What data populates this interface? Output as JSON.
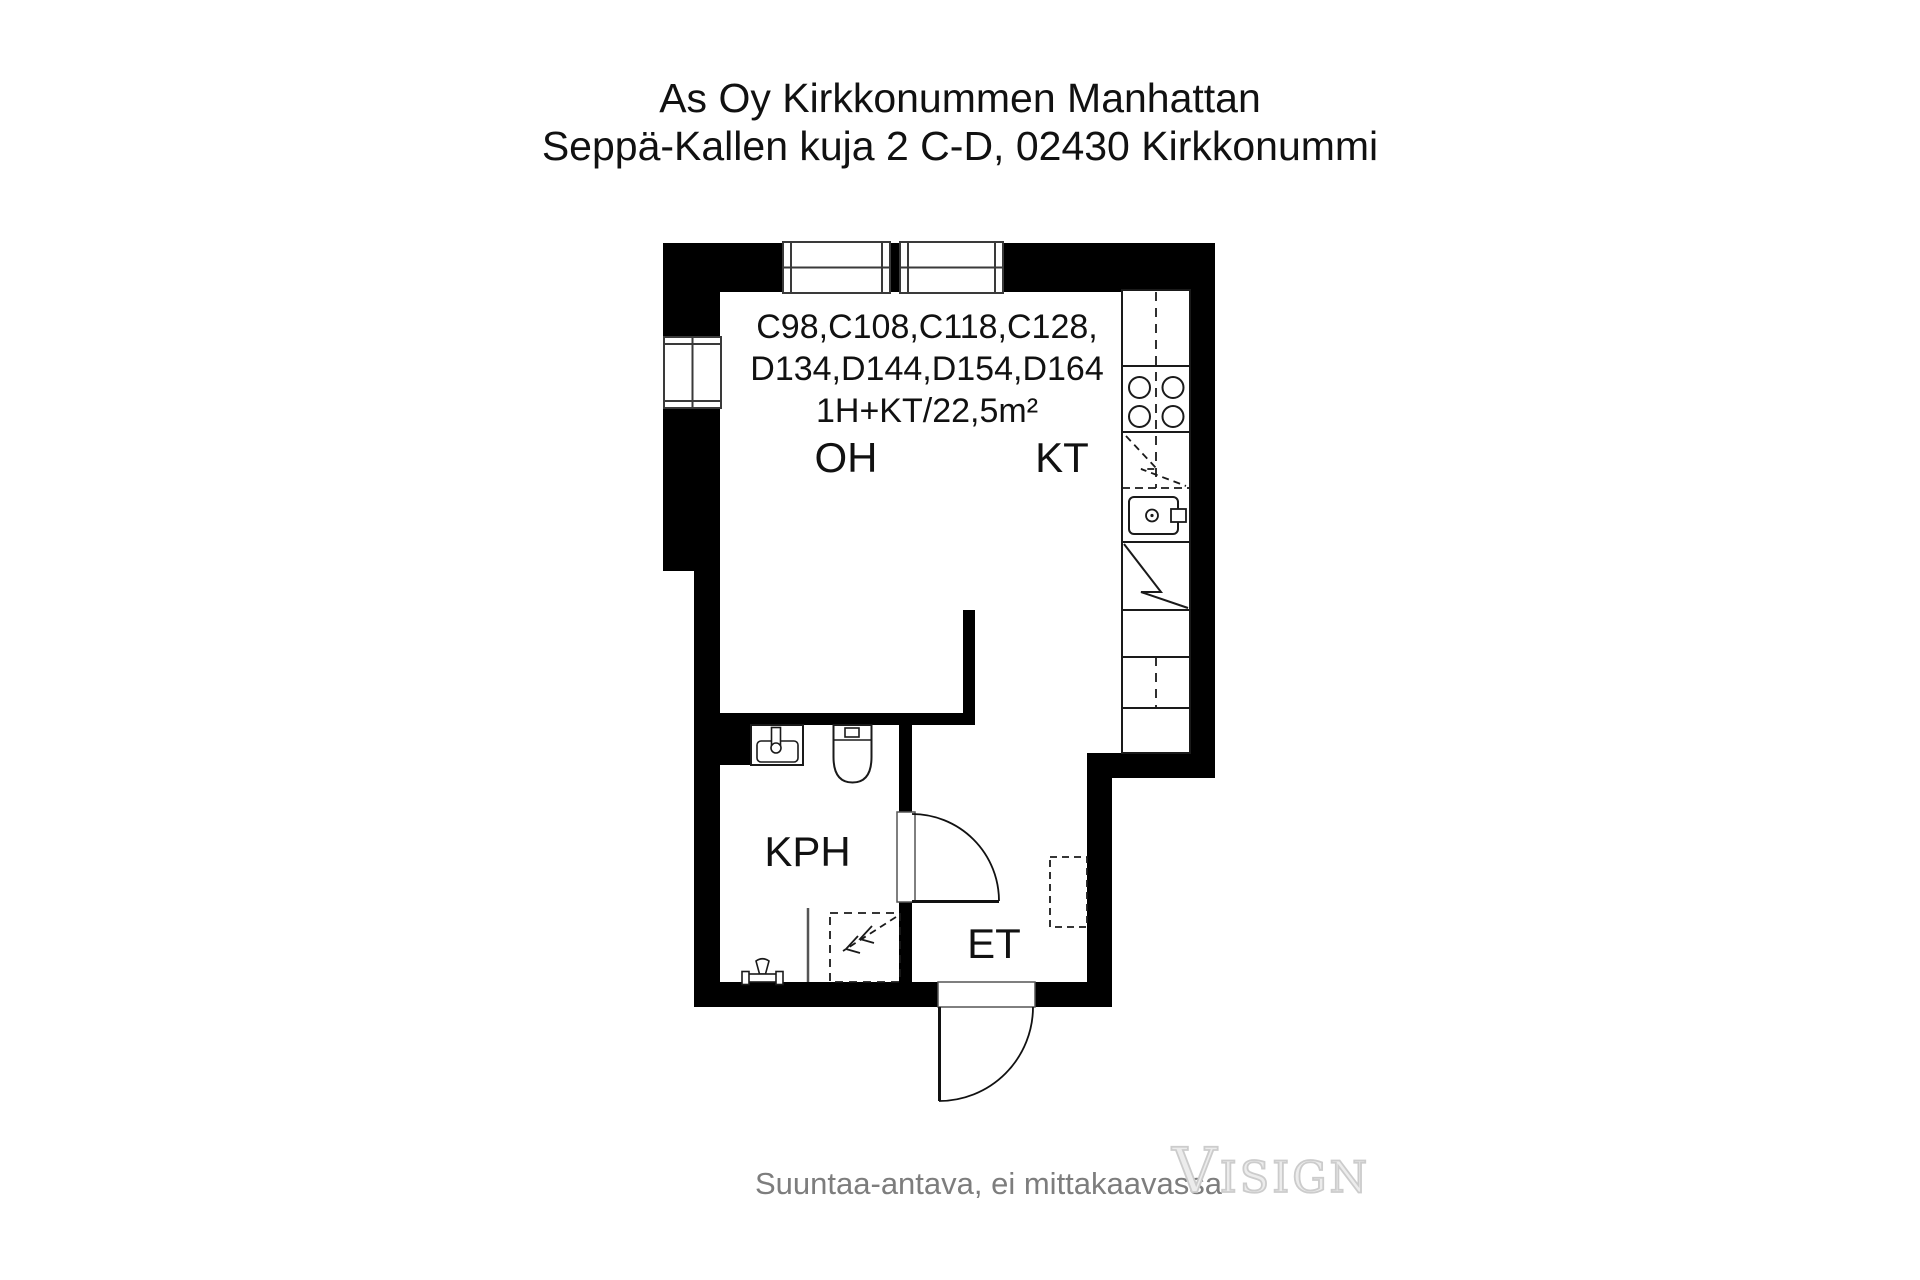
{
  "title": {
    "line1": "As Oy Kirkkonummen Manhattan",
    "line2": "Seppä-Kallen kuja 2 C-D, 02430 Kirkkonummi"
  },
  "unit": {
    "line1": "C98,C108,C118,C128,",
    "line2": "D134,D144,D154,D164",
    "line3": "1H+KT/22,5m²"
  },
  "rooms": {
    "living": "OH",
    "kitchen": "KT",
    "bathroom": "KPH",
    "entry": "ET"
  },
  "footer": {
    "disclaimer": "Suuntaa-antava, ei mittakaavassa",
    "logo": "Visign"
  },
  "colors": {
    "wall": "#000000",
    "background": "#ffffff",
    "line": "#1a1a1a",
    "muted_text": "#7d7d7d",
    "logo_outline": "#cccccc"
  }
}
